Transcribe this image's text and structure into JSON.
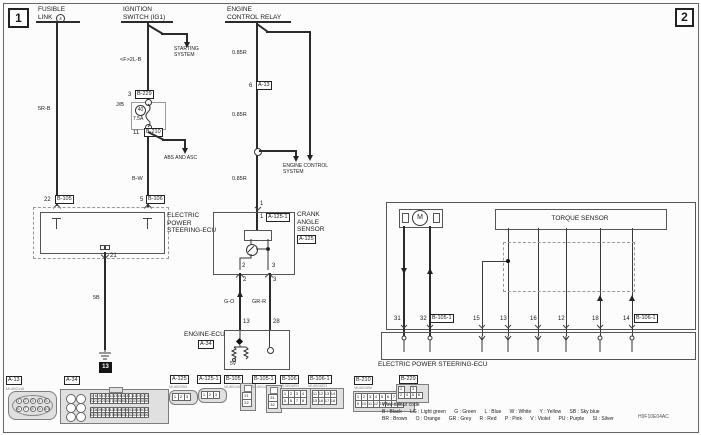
{
  "page": {
    "marker1": "1",
    "marker2": "2",
    "code": "H9F10E04AC"
  },
  "fusible": {
    "l1": "FUSIBLE",
    "l2": "LINK",
    "circ": "4",
    "wire": "5R-B",
    "pin": "22",
    "conn": "B-105"
  },
  "ignition": {
    "l1": "IGNITION",
    "l2": "SWITCH (IG1)",
    "branch": "STARTING\nSYSTEM",
    "wire_top": "<F>2L-B",
    "pin_top": "3",
    "conn_top": "B-229",
    "jb": "J/B",
    "fuse_no": "40",
    "fuse_amp": "7.5A",
    "pin_bot": "11",
    "conn_bot": "B-210",
    "branch2": "ABS AND ASC",
    "wire_bot": "B-W",
    "pin_ecu": "5",
    "conn_ecu": "B-106"
  },
  "relay": {
    "l1": "ENGINE",
    "l2": "CONTROL RELAY",
    "wire1": "0.85R",
    "pin": "6",
    "conn": "A-13",
    "wire2": "0.85R",
    "branch": "ENGINE CONTROL\nSYSTEM",
    "wire3": "0.85R",
    "pin_bot": "1"
  },
  "eps": {
    "label": "ELECTRIC\nPOWER\nSTEERING-ECU",
    "pin_gnd": "21",
    "gnd_wire": "5B",
    "gnd_id": "13"
  },
  "crank": {
    "label": "CRANK\nANGLE\nSENSOR",
    "conn": "A-125",
    "pin_top": "1",
    "pin_top_in": "1",
    "conn_top": "A-125-1",
    "p2": "2",
    "p3": "3",
    "p2b": "2",
    "p3b": "3",
    "wire_l": "G-O",
    "wire_r": "GR-R",
    "p13": "13",
    "p28": "28"
  },
  "eecu": {
    "label": "ENGINE-ECU",
    "conn": "A-34",
    "v5": "5V"
  },
  "right": {
    "torque": "TORQUE SENSOR",
    "motor": "M",
    "ecu": "ELECTRIC POWER STEERING-ECU",
    "p31": "31",
    "p32": "32",
    "c32": "B-105-1",
    "p15": "15",
    "p13": "13",
    "p16": "16",
    "p12": "12",
    "p18": "18",
    "p14": "14",
    "c14": "B-106-1"
  },
  "conn": {
    "a13": {
      "id": "A-13",
      "sub": "MU802148",
      "top": [
        "1",
        "2",
        "3",
        "4",
        "5"
      ],
      "bot": [
        "6",
        "7",
        "8",
        "9",
        "10"
      ]
    },
    "a34": {
      "id": "A-34",
      "g1": [
        [
          "1",
          "6",
          "9",
          "10",
          "11",
          "12",
          "13",
          "14",
          "15",
          "16",
          "17",
          "18",
          "19",
          "20",
          "21"
        ],
        [
          "22",
          "23",
          "24",
          "25",
          "26",
          "27",
          "28",
          "29",
          "30",
          "31",
          "32",
          "33",
          "34",
          "35",
          "36"
        ]
      ],
      "g2": [
        [
          "37",
          "38",
          "39",
          "40",
          "41",
          "42",
          "43",
          "44",
          "45",
          "46",
          "47",
          "48",
          "49",
          "50",
          "51"
        ],
        [
          "52",
          "53",
          "54",
          "55",
          "56",
          "57",
          "58",
          "59",
          "60",
          "61",
          "62",
          "63",
          "64",
          "65",
          "66"
        ]
      ]
    },
    "a125": {
      "id": "A-125",
      "sub": "MU802953",
      "cells": [
        "1",
        "2",
        "3"
      ]
    },
    "a125_1": {
      "id": "A-125-1",
      "cells": [
        "1",
        "2",
        "3"
      ]
    },
    "b105": {
      "id": "B-105",
      "sub": "MU801405",
      "cells": [
        "21",
        "22"
      ]
    },
    "b105_1": {
      "id": "B-105-1",
      "sub": "MU801405",
      "cells": [
        "31",
        "32"
      ]
    },
    "b106": {
      "id": "B-106",
      "sub": "MU8016ED",
      "rows": [
        [
          "1",
          "2",
          "3",
          "4"
        ],
        [
          "5",
          "6",
          "7",
          "8"
        ]
      ]
    },
    "b106_1": {
      "id": "B-106-1",
      "sub": "MU8016ED",
      "rows": [
        [
          "11",
          "12",
          "13",
          "14"
        ],
        [
          "15",
          "16",
          "17",
          "18"
        ]
      ]
    },
    "b210": {
      "id": "B-210",
      "sub": "MU801596",
      "rows": [
        [
          "1",
          "2",
          "3",
          "4",
          "5",
          "6",
          "7",
          "8"
        ],
        [
          "9",
          "10",
          "11",
          "12",
          "13",
          "14",
          "15",
          "16"
        ]
      ]
    },
    "b229": {
      "id": "B-229",
      "rows": [
        [
          "1",
          "",
          "3"
        ],
        [
          "2",
          "4",
          "5",
          "6"
        ]
      ]
    }
  },
  "wire_code": {
    "title": "Wire colour code",
    "line1": "B : Black      LG : Light green      G : Green      L : Blue      W : White      Y : Yellow      SB : Sky blue",
    "line2": "BR : Brown      O : Orange      GR : Grey      R : Red      P : Pink      V : Violet      PU : Purple      SI : Silver"
  }
}
